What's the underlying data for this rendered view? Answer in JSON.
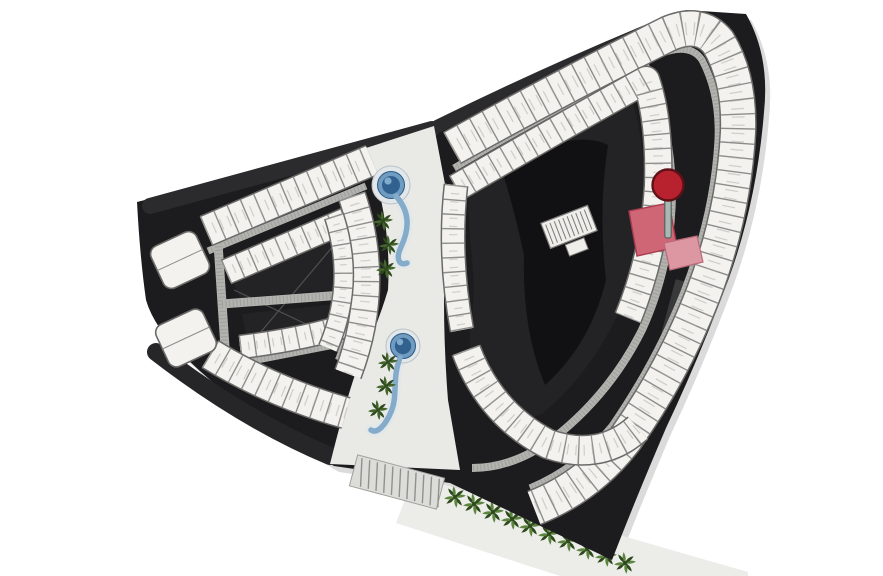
{
  "view": {
    "width": 883,
    "height": 576,
    "background": "#ffffff",
    "title": "masterplan-floor-plan"
  },
  "palette": {
    "site_dark": "#1c1c1e",
    "roof_shade": "#2b2b2d",
    "courtyard": "#232325",
    "courtyard_core": "#111113",
    "unit_fill": "#f3f2ee",
    "unit_edge": "#6a6a68",
    "unit_divider": "#8d8d8b",
    "corridor_gray": "#b2b2af",
    "corridor_texture": "#8f8f8d",
    "walkway_light": "#e9eae6",
    "promenade_light": "#ecede9",
    "crosswalk_fill": "#dcdcd8",
    "crosswalk_line": "#90908d",
    "pool_deck": "#e2e7e9",
    "pool_rim": "#6f9cc0",
    "pool_deep": "#31618e",
    "pool_stream": "#85abca",
    "palm_dark": "#2e4a1d",
    "palm_mid": "#44662c",
    "palm_light": "#5d8540",
    "shadow": "rgba(0,0,0,0.14)",
    "stairs_fill": "#efeeea",
    "stairs_line": "#7a7a78"
  },
  "marker": {
    "name": "selected-unit-pin",
    "color": "#b8212e",
    "edge": "#5f1118",
    "stick": "#a9b8b2",
    "stick_edge": "#54625e"
  },
  "highlight": {
    "primary": "#cf6676",
    "primary_edge": "#a93b4e",
    "secondary": "#dd97a3",
    "secondary_edge": "#bb6a78"
  },
  "landscape": {
    "pools": 2,
    "corridor_palms": 6,
    "promenade_palms": 10
  },
  "buildings": {
    "left_wing": "left-wing-block",
    "right_wing": "right-wing-block"
  }
}
